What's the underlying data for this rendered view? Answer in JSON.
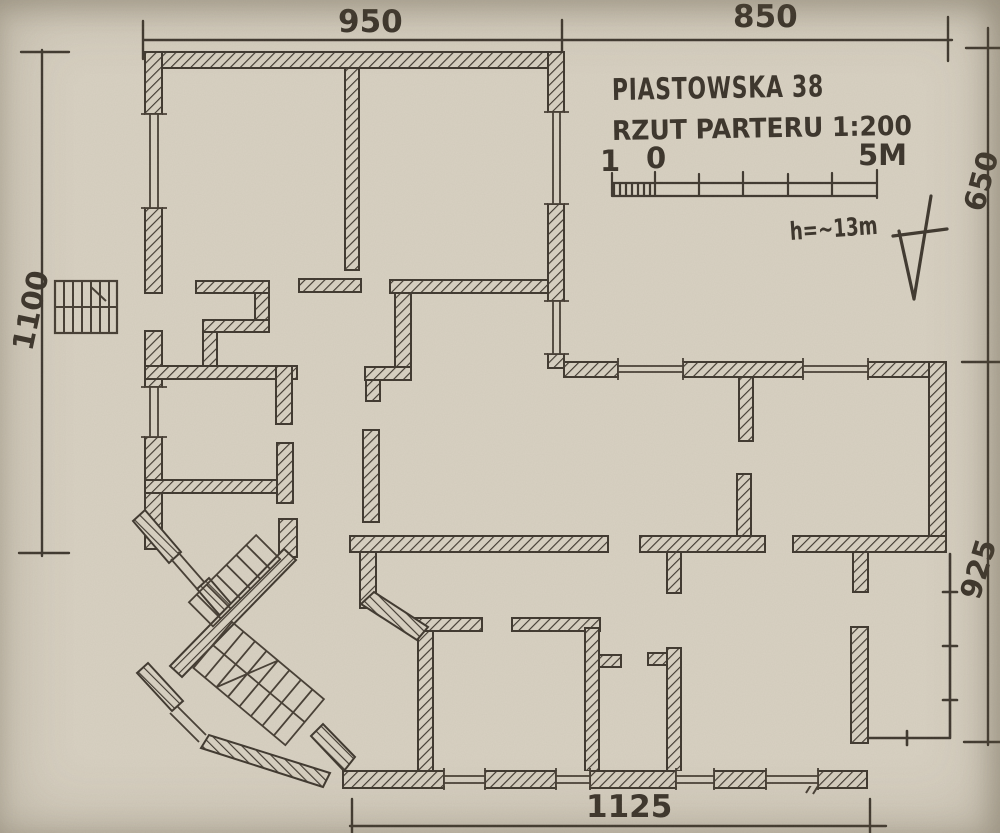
{
  "plan": {
    "title": "PIASTOWSKA 38",
    "subtitle": "RZUT PARTERU 1:200",
    "height_note": "h=~13m",
    "scale_bar": {
      "left": "1",
      "zero": "0",
      "right": "5M"
    },
    "dimensions": {
      "top_left": "950",
      "top_right": "850",
      "left": "1100",
      "right_upper": "650",
      "right_lower": "925",
      "bottom": "1125"
    },
    "colors": {
      "paper": "#d8d1c2",
      "ink": "#3e372e"
    }
  }
}
